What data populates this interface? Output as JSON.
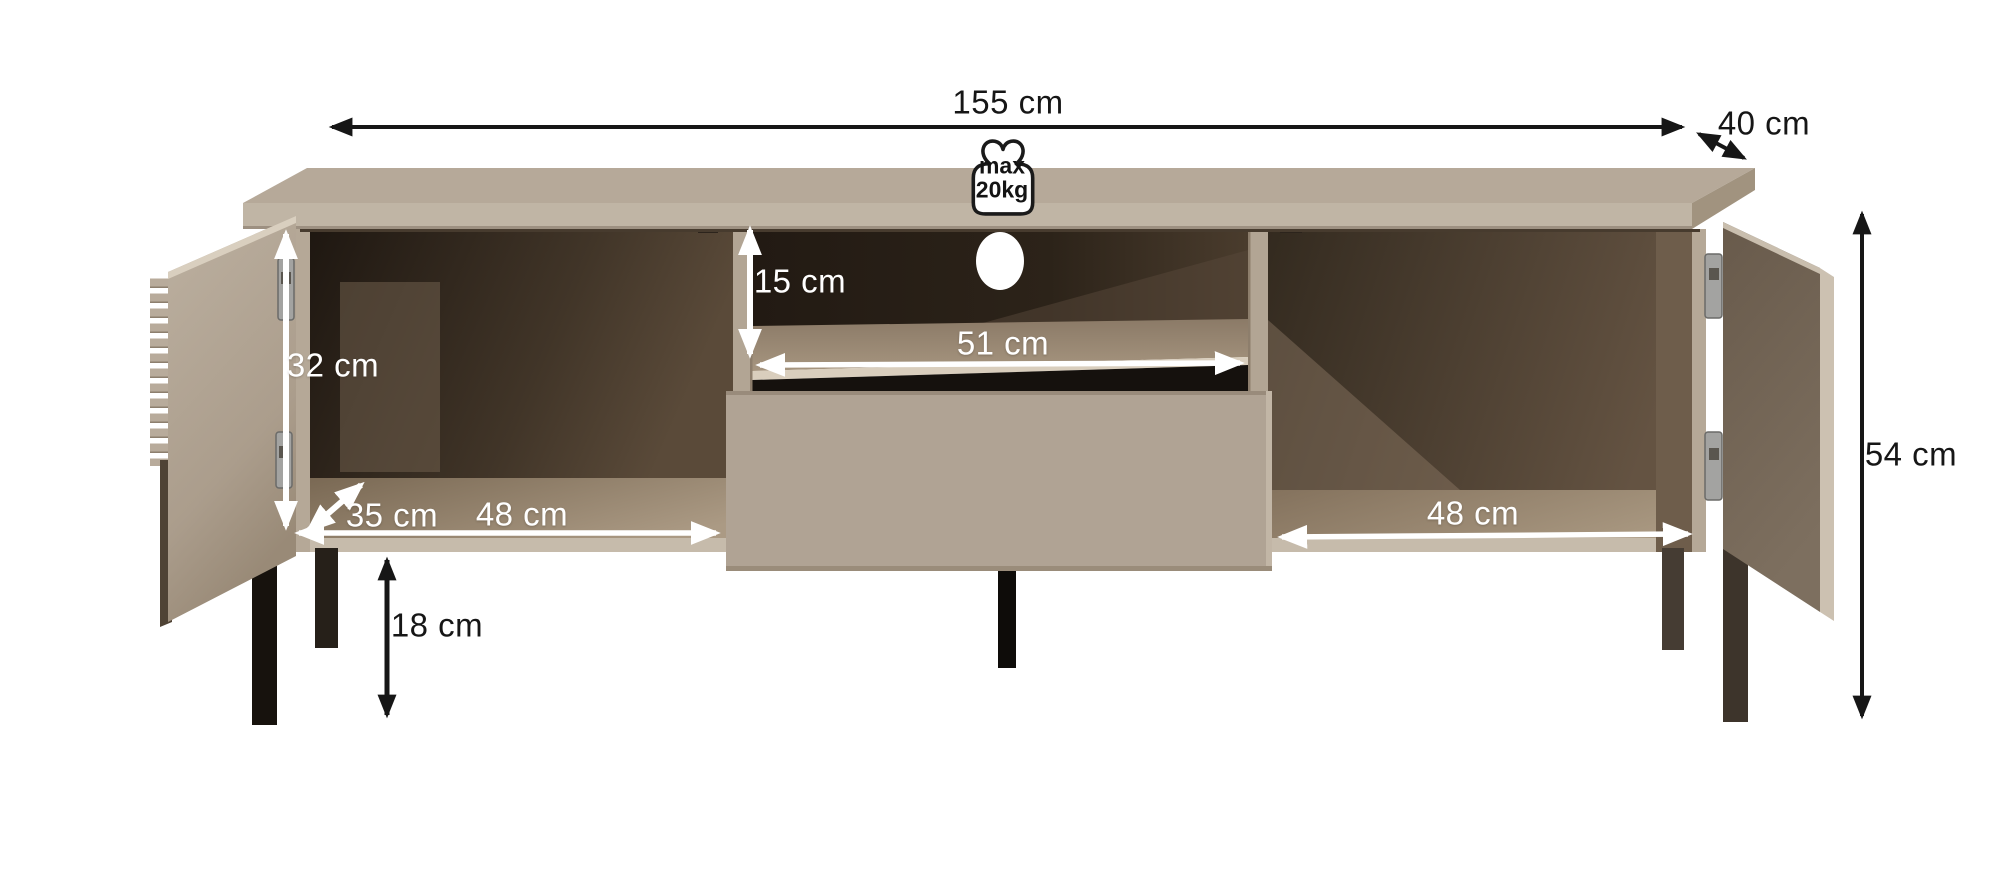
{
  "diagram": {
    "type": "furniture-dimension-diagram",
    "subject": "TV cabinet with two open doors, open central drawer and open media shelf",
    "dimensions": {
      "total_width": "155 cm",
      "total_depth": "40 cm",
      "total_height": "54 cm",
      "leg_height": "18 cm",
      "door_compartment_height": "32 cm",
      "compartment_depth": "35 cm",
      "left_compartment_width": "48 cm",
      "open_shelf_height": "15 cm",
      "open_shelf_width": "51 cm",
      "right_compartment_width": "48 cm"
    },
    "max_load": {
      "line1": "max",
      "line2": "20kg"
    },
    "colors": {
      "body": "#b7aa9a",
      "top_front_face": "#c0b5a5",
      "edge_highlight": "#d9cebd",
      "interior_dark": "#241c14",
      "interior_floor": "#a5947e",
      "right_door_inner": "#6e6051",
      "legs_dark": "#17120d",
      "legs_right": "#3d342b",
      "dimension_black": "#161616",
      "dimension_white": "#ffffff"
    }
  }
}
